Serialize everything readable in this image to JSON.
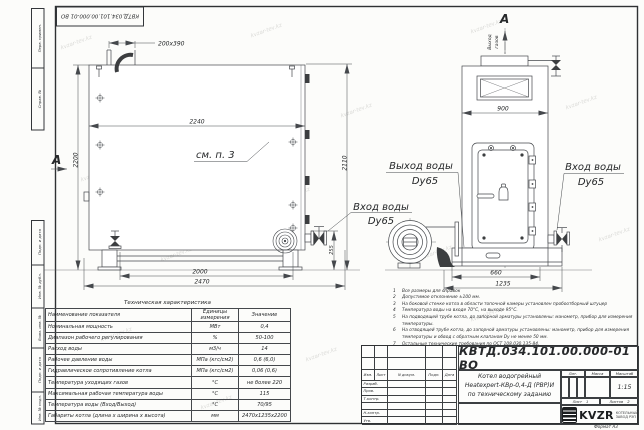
{
  "watermark": {
    "text": "kvzar-tev.kz"
  },
  "stamp": {
    "designation": "КВТД.034.101.00.000-01 ВО"
  },
  "frame_labels": {
    "top": [
      "Перв. примен.",
      "Справ. №"
    ],
    "bottom": [
      "Подп. и дата",
      "Инв. № дубл.",
      "Взам. инв. №",
      "Подп. и дата",
      "Инв. № подл."
    ]
  },
  "side_view": {
    "section_letter": "А",
    "see_note": "см. п. 3",
    "dims": {
      "hatch": "200x390",
      "width": "2240",
      "height_left": "2200",
      "height_right": "2110",
      "base": "2000",
      "overall": "2470",
      "nozzle": "255"
    },
    "inlet": {
      "line1": "Вход воды",
      "line2": "Dy65"
    }
  },
  "front_view": {
    "section_letter": "А",
    "gas_outlet": {
      "line1": "Выход",
      "line2": "газов"
    },
    "dims": {
      "width": "900",
      "base": "660",
      "overall": "1235"
    },
    "outlet": {
      "line1": "Выход воды",
      "line2": "Dy65"
    },
    "inlet": {
      "line1": "Вход воды",
      "line2": "Dy65"
    }
  },
  "tech_table": {
    "title": "Техническая характеристика",
    "headers": [
      "Наименование показателя",
      "Единицы измерения",
      "Значение"
    ],
    "rows": [
      [
        "Номинальная мощность",
        "МВт",
        "0,4"
      ],
      [
        "Диапазон рабочего регулирования",
        "%",
        "50-100"
      ],
      [
        "Расход воды",
        "м3/ч",
        "14"
      ],
      [
        "Рабочее давление воды",
        "МПа (кгс/см2)",
        "0,6 (6,0)"
      ],
      [
        "Гидравлическое сопротивление котла",
        "МПа (кгс/см2)",
        "0,06 (0,6)"
      ],
      [
        "Температура уходящих газов",
        "°С",
        "не более 220"
      ],
      [
        "Максимальная рабочая температура воды",
        "°С",
        "115"
      ],
      [
        "Температура воды (Вход/Выход)",
        "°С",
        "70/95"
      ],
      [
        "Габариты котла (длина х ширина х высота)",
        "мм",
        "2470х1235х2200"
      ]
    ]
  },
  "notes": {
    "items": [
      {
        "n": "1",
        "text": "Все размеры для справок"
      },
      {
        "n": "2",
        "text": "Допустимое отклонение ±100 мм."
      },
      {
        "n": "3",
        "text": "На боковой стенке котла в области топочной камеры установлен пробоотборный штуцер"
      },
      {
        "n": "4",
        "text": "Температура воды на входе 70°С, на выходе 95°С."
      },
      {
        "n": "5",
        "text": "На подводящей трубе котла, до запорной арматуры установлены: манометр, прибор для измерения температуры."
      },
      {
        "n": "6",
        "text": "На отводящей трубе котла, до запорной арматуры установлены: манометр, прибор для измерения температуры и обвод с обратным клапаном Dy не менее 50 мм."
      },
      {
        "n": "7",
        "text": "Остальные технические требования по ОСТ 108.030.135-84."
      }
    ]
  },
  "title_block": {
    "designation": "КВТД.034.101.00.000-01 ВО",
    "name_line1": "Котел водогрейный",
    "name_line2": "Heatexpert-КВр-0,4-Д (РВР)И",
    "name_line3": "по техническому заданию",
    "cols": {
      "izm": "Изм.",
      "list": "Лист",
      "doc": "N докум.",
      "podp": "Подп.",
      "data": "Дата"
    },
    "sign_rows": {
      "razrab": "Разраб.",
      "prov": "Пров.",
      "tkontr": "Т.контр.",
      "nkontr": "Н.контр.",
      "utv": "Утв."
    },
    "lit": "Лит.",
    "mass": "Масса",
    "scale": "Масштаб",
    "scale_value": "1:15",
    "sheet_label": "Лист",
    "sheet_value": "1",
    "sheets_label": "Листов",
    "sheets_value": "2",
    "logo": {
      "name": "KVZR",
      "sub1": "КОТЕЛЬНЫЙ",
      "sub2": "ЗАВОД РЭП"
    },
    "format": "Формат А3"
  }
}
